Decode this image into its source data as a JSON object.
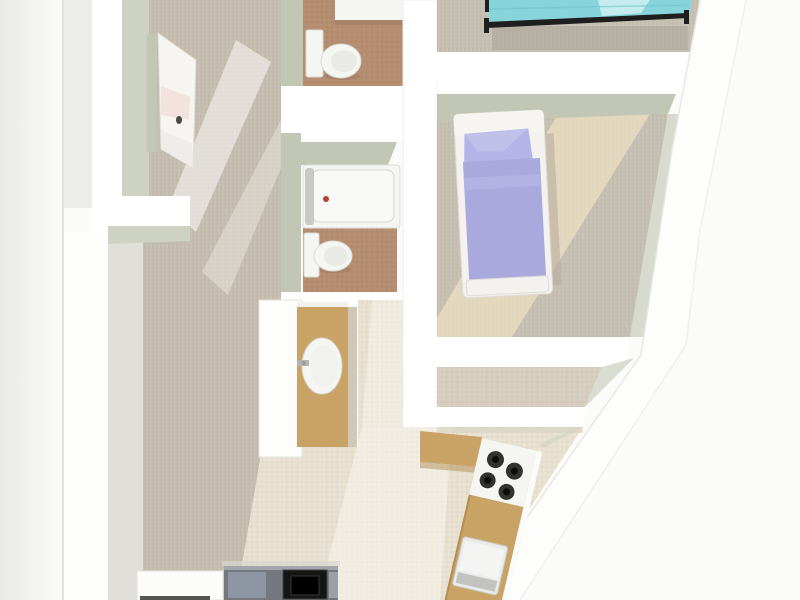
{
  "scene": {
    "type": "3d-floor-plan-top-view",
    "description": "Rendered 3D top-down floor plan of a narrow apartment with slanted right exterior wall"
  },
  "objects": {
    "entry_door": "open white entry door with dark handle",
    "toilet_top": "toilet in upper bathroom",
    "sink_counter_top": "white counter in upper bathroom",
    "bathtub": "white bathtub with red drain dot",
    "toilet_mid": "toilet in middle bathroom",
    "vanity_sink": "gold vanity cabinet with oval white sink",
    "bed_teal": "bed with teal bedding and black metal frame",
    "bed_purple": "single bed with lavender bedding and white frame",
    "kitchen_counter": "gold kitchen counter along slanted wall",
    "cooktop": "four-burner cooktop",
    "kitchen_sink": "kitchen sink basin",
    "white_counter": "white kitchen cabinet at bottom",
    "dark_appliance": "dark range appliance at bottom"
  },
  "palette": {
    "outside": "#fbfbfa",
    "outside_edge": "#e9e9e7",
    "ledge_gray": "#ececea",
    "wall_white": "#ffffff",
    "wall_white_soft": "#fdfdfc",
    "wall_shade": "#c2c6b4",
    "wall_shade_light": "#ced2c3",
    "wall_inner_pale": "#e0dfda",
    "carpet": "#c6beb0",
    "bedroom_carpet": "#c7c1b3",
    "closet_floor": "#d9d0c1",
    "bath_floor": "#b78f72",
    "cream_floor": "#ebe3d2",
    "streak_warm": "#ecdfc2",
    "gold": "#c9a365",
    "gold_edge": "#b28d55",
    "fixture_white": "#f5f5f2",
    "tub_inner": "#f8f8f6",
    "teal": "#87d5db",
    "teal_light": "#c4ecef",
    "bed_frame_black": "#1e1e1e",
    "purple": "#a9a9de",
    "purple_pillow": "#b4b4e8",
    "purple_fold": "#b2b2e4",
    "frame_white": "#f3f2ef",
    "burner": "#32322f",
    "sink_gray": "#ebebe9",
    "sink_lip": "#c2c2c0",
    "appliance_body": "#75787f",
    "appliance_top": "#a3a7ad",
    "appliance_blue": "#8e96a4",
    "appliance_panel": "#9ba0a7",
    "appliance_black": "#151515",
    "drain_red": "#b2432f",
    "door_panel": "#f7f5f2",
    "door_pink": "#f2e3de",
    "handle_dark": "#4b4b45",
    "shadow_warm": "#aaa398",
    "shadow_bed": "#b5ae9f",
    "counter_white": "#fcfcfb",
    "dark_sliver": "#55564f"
  }
}
